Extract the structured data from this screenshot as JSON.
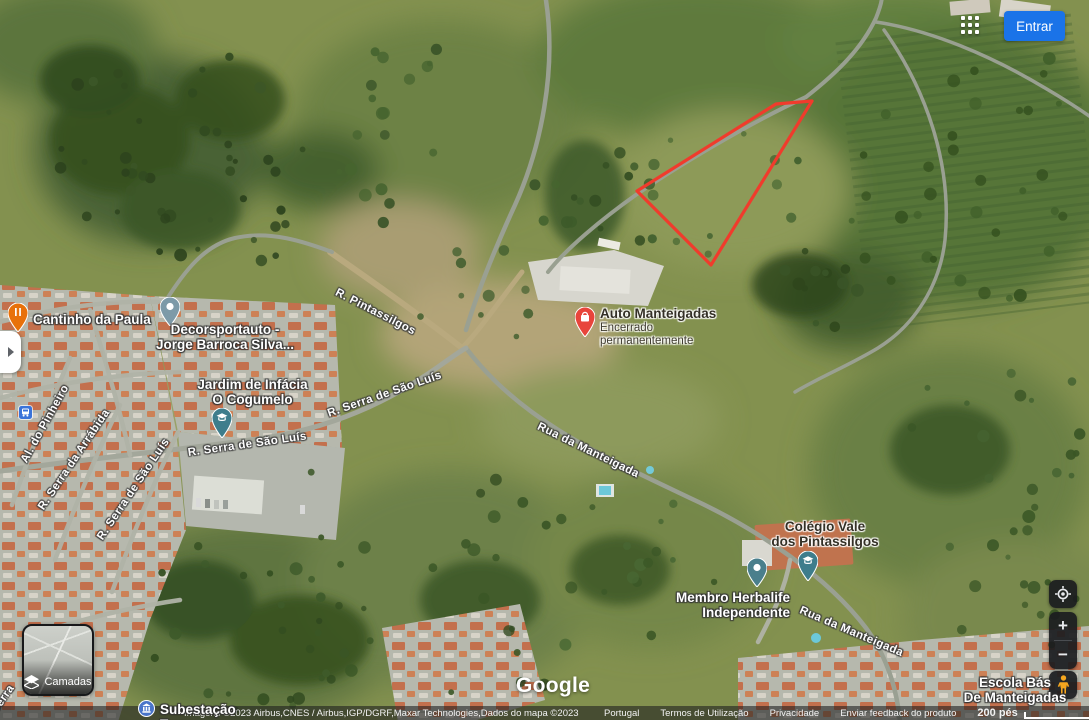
{
  "header": {
    "signin": "Entrar"
  },
  "colors": {
    "accent": "#1a73e8",
    "parcel": "#f03b2c"
  },
  "places": {
    "cantinho": {
      "label": "Cantinho da Paula"
    },
    "decorsportauto": {
      "line1": "Decorsportauto -",
      "line2": "Jorge Barroca Silva..."
    },
    "jardim": {
      "line1": "Jardim de Infácia",
      "line2": "O Cogumelo"
    },
    "auto_manteigadas": {
      "title": "Auto Manteigadas",
      "status1": "Encerrado",
      "status2": "permanentemente"
    },
    "colegio": {
      "line1": "Colégio Vale",
      "line2": "dos Pintassilgos"
    },
    "herbalife": {
      "line1": "Membro Herbalife",
      "line2": "Independente"
    },
    "subestacao": {
      "label": "Subestação Terro..."
    },
    "escola": {
      "line1": "Escola Bás",
      "line2": "De Manteigadas"
    }
  },
  "streets": {
    "pintassilgos": "R. Pintassilgos",
    "sao_luis_upper": "R. Serra de São Luís",
    "sao_luis_lower": "R. Serra de São Luís",
    "sao_luis_left": "R. Serra de São Luís",
    "arrabida": "R. Serra da Arrábida",
    "pinheiro": "Al. do Pinheiro",
    "manteigada_mid": "Rua da Manteigada",
    "manteigada_se": "Rua da Manteigada",
    "corner_partial": "Serra"
  },
  "controls": {
    "layers_label": "Camadas",
    "zoom_in": "+",
    "zoom_out": "−"
  },
  "branding": {
    "logo": "Google"
  },
  "footer": {
    "attribution": "Imagens ©2023 Airbus,CNES / Airbus,IGP/DGRF,Maxar Technologies,Dados do mapa ©2023",
    "country": "Portugal",
    "terms": "Termos de Utilização",
    "privacy": "Privacidade",
    "feedback": "Enviar feedback do produto",
    "scale": "200 pés"
  }
}
